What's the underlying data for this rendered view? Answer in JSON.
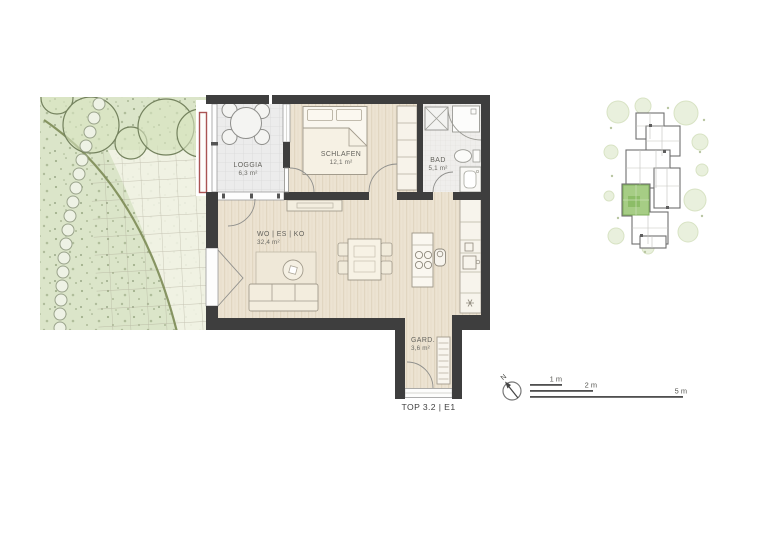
{
  "plan": {
    "unit_label": "TOP 3.2 | E1",
    "rooms": [
      {
        "id": "loggia",
        "name": "LOGGIA",
        "area": "6,3 m²"
      },
      {
        "id": "schlafen",
        "name": "SCHLAFEN",
        "area": "12,1 m²"
      },
      {
        "id": "bad",
        "name": "BAD",
        "area": "5,1 m²"
      },
      {
        "id": "wohnen",
        "name": "WO | ES | KO",
        "area": "32,4 m²"
      },
      {
        "id": "gard",
        "name": "GARD.",
        "area": "3,6 m²"
      }
    ]
  },
  "scale_bar": {
    "segments": [
      {
        "label": "1 m"
      },
      {
        "label": "2 m"
      },
      {
        "label": "5 m"
      }
    ]
  },
  "compass": {
    "north_label": "N"
  },
  "colors": {
    "wall": "#3e3e3e",
    "wood_floor": "#ece3d2",
    "garden_green": "#dbe5c9",
    "paving_light": "#f3f5e7",
    "highlight_unit": "#a6cd85",
    "planter_red": "#aa5454"
  }
}
